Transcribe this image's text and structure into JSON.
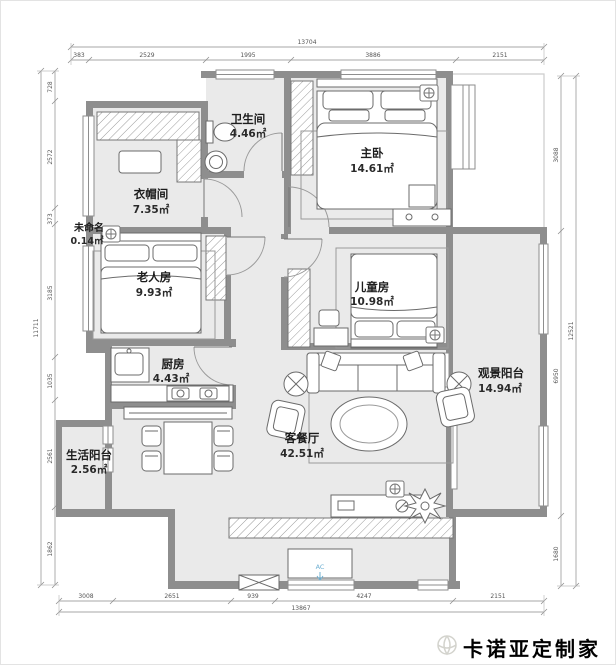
{
  "rooms": {
    "bathroom": {
      "name": "卫生间",
      "area": "4.46㎡"
    },
    "cloakroom": {
      "name": "衣帽间",
      "area": "7.35㎡"
    },
    "master": {
      "name": "主卧",
      "area": "14.61㎡"
    },
    "unnamed": {
      "name": "未命名",
      "area": "0.14㎡"
    },
    "elder": {
      "name": "老人房",
      "area": "9.93㎡"
    },
    "kids": {
      "name": "儿童房",
      "area": "10.98㎡"
    },
    "kitchen": {
      "name": "厨房",
      "area": "4.43㎡"
    },
    "view_balcony": {
      "name": "观景阳台",
      "area": "14.94㎡"
    },
    "living": {
      "name": "客餐厅",
      "area": "42.51㎡"
    },
    "life_balcony": {
      "name": "生活阳台",
      "area": "2.56㎡"
    }
  },
  "dims": {
    "top": {
      "total": "13704",
      "segs": [
        "383",
        "2529",
        "1995",
        "3886",
        "2151"
      ]
    },
    "bottom": {
      "total": "13867",
      "segs": [
        "3008",
        "2651",
        "939",
        "4247",
        "2151"
      ]
    },
    "left": {
      "total": "11711",
      "segs": [
        "728",
        "2572",
        "373",
        "3185",
        "1035",
        "2561",
        "1862"
      ]
    },
    "right": {
      "total": "12521",
      "segs": [
        "3088",
        "6950",
        "1680"
      ]
    }
  },
  "labels": {
    "ac": "AC"
  },
  "watermark": {
    "brand": "卡诺亚定制家居"
  },
  "colors": {
    "wall": "#8e8e8e",
    "floor": "#eaeaea",
    "accent": "#6fb0d2"
  }
}
